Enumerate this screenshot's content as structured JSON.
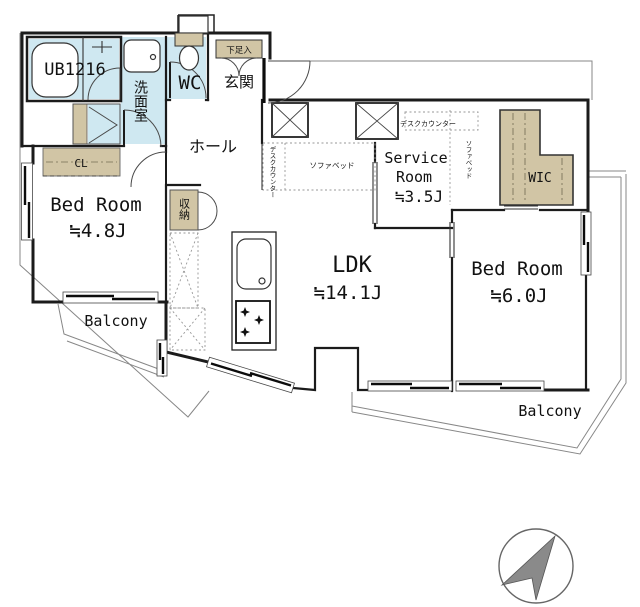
{
  "rooms": {
    "unit_bath": {
      "label": "UB1216"
    },
    "washroom": {
      "label": "洗面室"
    },
    "toilet": {
      "label": "WC"
    },
    "entrance": {
      "label": "玄関"
    },
    "shoe_cabinet": {
      "label": "下足入"
    },
    "hall": {
      "label": "ホール"
    },
    "closet": {
      "label": "CL"
    },
    "storage": {
      "label": "収納"
    },
    "bedroom_west": {
      "label": "Bed Room",
      "size": "≒4.8J"
    },
    "service_room": {
      "line1": "Service",
      "line2": "Room",
      "size": "≒3.5J"
    },
    "ldk": {
      "label": "LDK",
      "size": "≒14.1J"
    },
    "bedroom_east": {
      "label": "Bed Room",
      "size": "≒6.0J"
    },
    "wic": {
      "label": "WIC"
    },
    "balcony_west": {
      "label": "Balcony"
    },
    "balcony_south": {
      "label": "Balcony"
    }
  },
  "furniture": {
    "ldk_desk_counter": {
      "label": "デスクカウンター"
    },
    "ldk_sofa_bed": {
      "label": "ソファベッド"
    },
    "service_desk_counter": {
      "label": "デスクカウンター"
    },
    "service_sofa_bed": {
      "label": "ソファベッド"
    }
  },
  "colors": {
    "water": "#cfe8f1",
    "storage_tan": "#d1c5a5",
    "wall": "#1b1b1b",
    "compass_gray": "#8a8a8a"
  }
}
